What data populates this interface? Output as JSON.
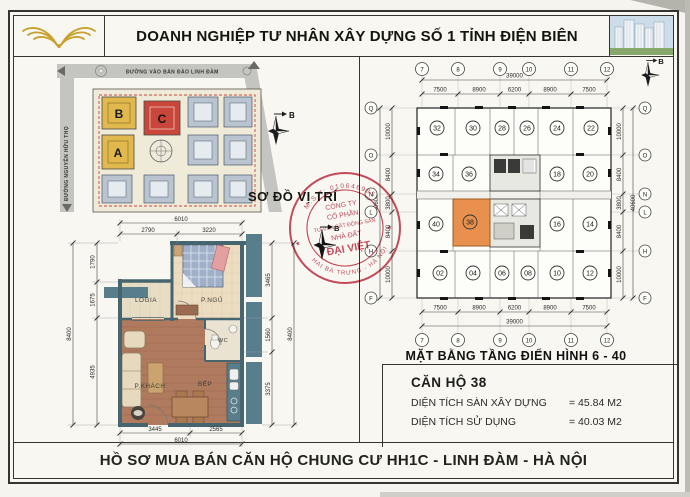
{
  "header": {
    "company_name": "DOANH NGHIỆP TƯ NHÂN XÂY DỰNG SỐ 1 TỈNH ĐIỆN BIÊN"
  },
  "footer": {
    "document_title": "HỒ SƠ MUA BÁN CĂN HỘ CHUNG CƯ HH1C - LINH ĐÀM - HÀ NỘI"
  },
  "site_map": {
    "label": "SƠ ĐỒ VỊ TRÍ",
    "street_top": "ĐƯỜNG VÀO BÁN ĐẢO LINH ĐÀM",
    "street_left": "ĐƯỜNG NGUYỄN HỮU THỌ",
    "block_a": "A",
    "block_b": "B",
    "block_c": "C",
    "colors": {
      "block_ab": "#e0b84e",
      "block_c": "#c8473a",
      "road": "#c4c4c0"
    }
  },
  "compass": {
    "north": "B"
  },
  "apartment": {
    "rooms": {
      "logia": "LOGIA",
      "bedroom": "P.NGỦ",
      "wc": "WC",
      "living": "P.KHÁCH",
      "kitchen": "BẾP"
    },
    "dims": {
      "top_total": "6010",
      "top_segs": [
        "2790",
        "3220"
      ],
      "left_total": "8400",
      "left_segs": [
        "1790",
        "1675",
        "4935"
      ],
      "right_total": "8400",
      "right_segs": [
        "3465",
        "1560",
        "3375"
      ],
      "bottom_total": "6010",
      "bottom_segs": [
        "3445",
        "2565"
      ]
    }
  },
  "floor_plan": {
    "title": "MẶT BẰNG TẦNG ĐIỂN HÌNH 6 - 40",
    "col_axes": [
      "7",
      "8",
      "9",
      "10",
      "11",
      "12"
    ],
    "row_axes": [
      "Q",
      "O",
      "N",
      "L",
      "H",
      "F"
    ],
    "h_total": "39000",
    "h_segs": [
      "7500",
      "8900",
      "6200",
      "8900",
      "7500"
    ],
    "v_total": "40600",
    "v_segs": [
      "10000",
      "8400",
      "3800",
      "8400",
      "10000"
    ],
    "units_top": [
      "32",
      "30",
      "28",
      "26",
      "24",
      "22"
    ],
    "units_west": [
      "34",
      "36",
      "40",
      "38"
    ],
    "units_east": [
      "18",
      "20",
      "16",
      "14"
    ],
    "units_bottom": [
      "02",
      "04",
      "06",
      "08",
      "10",
      "12"
    ],
    "highlight_unit": "38",
    "highlight_color": "#e8914e"
  },
  "unit_info": {
    "title": "CĂN HỘ 38",
    "rows": [
      {
        "label": "DIỆN TÍCH SÀN XÂY DỰNG",
        "value": "= 45.84 M2"
      },
      {
        "label": "DIỆN TÍCH SỬ DỤNG",
        "value": "= 40.03 M2"
      }
    ]
  },
  "stamp": {
    "arc_top": "M.S.T: 010646985",
    "arc_bottom": "HAI BÀ TRƯNG - HÀ NỘI",
    "line1": "CÔNG TY",
    "line2": "CỔ PHẦN",
    "line3": "TƯ VẤN BẤT ĐỘNG SẢN",
    "line4": "NHÀ ĐẤT",
    "line5": "ĐẠI VIỆT"
  }
}
